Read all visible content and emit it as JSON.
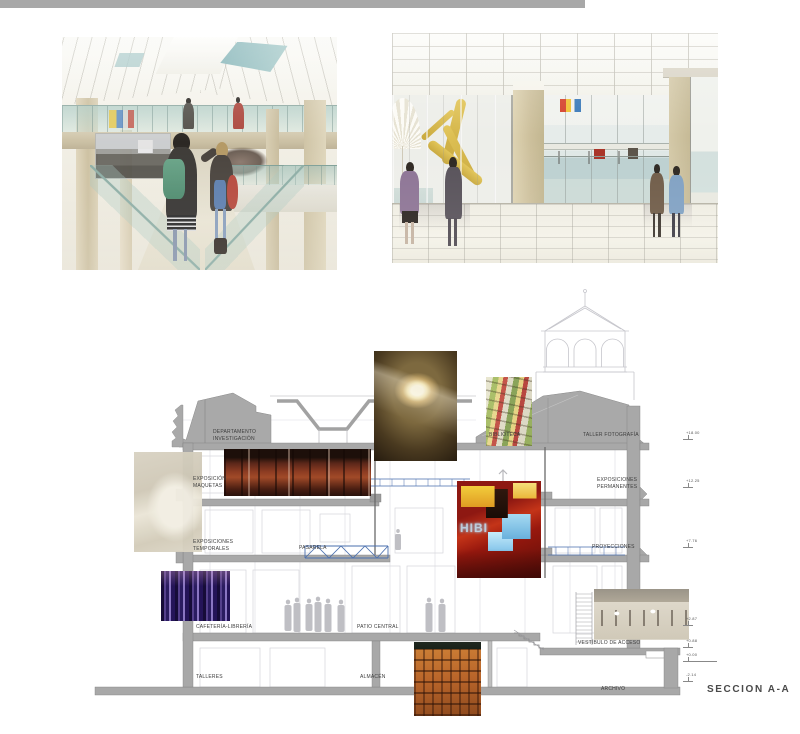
{
  "board": {
    "section_title": "SECCION A-A"
  },
  "section": {
    "labels": {
      "departamento_investigacion": "DEPARTAMENTO\nINVESTIGACIÓN",
      "exposicion_maquetas": "EXPOSICIÓN\nMAQUETAS",
      "exposiciones_temporales": "EXPOSICIONES\nTEMPORALES",
      "cafeteria_libreria": "CAFETERÍA-LIBRERÍA",
      "talleres": "TALLERES",
      "pasarela": "PASARELA",
      "patio_central": "PATIO CENTRAL",
      "almacen": "ALMACÉN",
      "biblioteca": "BIBLIOTECA",
      "taller_fotografia": "TALLER FOTOGRAFÍA",
      "exposiciones_permanentes": "EXPOSICIONES\nPERMANENTES",
      "proyecciones": "PROYECCIONES",
      "vestibulo_acceso": "VESTÍBULO DE ACCESO",
      "archivo": "ARCHIVO"
    },
    "elevations": [
      "+18.00",
      "+12.25",
      "+7.76",
      "+2.87",
      "+0.88",
      "+0.00",
      "-2.14"
    ],
    "photo_overlay_text": "HIBI",
    "colors": {
      "slab_gray": "#a8a8a8",
      "truss_blue": "#4a6fae",
      "beige_column": "#d6cbaa",
      "glass_teal": "#cfe0db",
      "outline_light": "#c6c6cc"
    }
  }
}
